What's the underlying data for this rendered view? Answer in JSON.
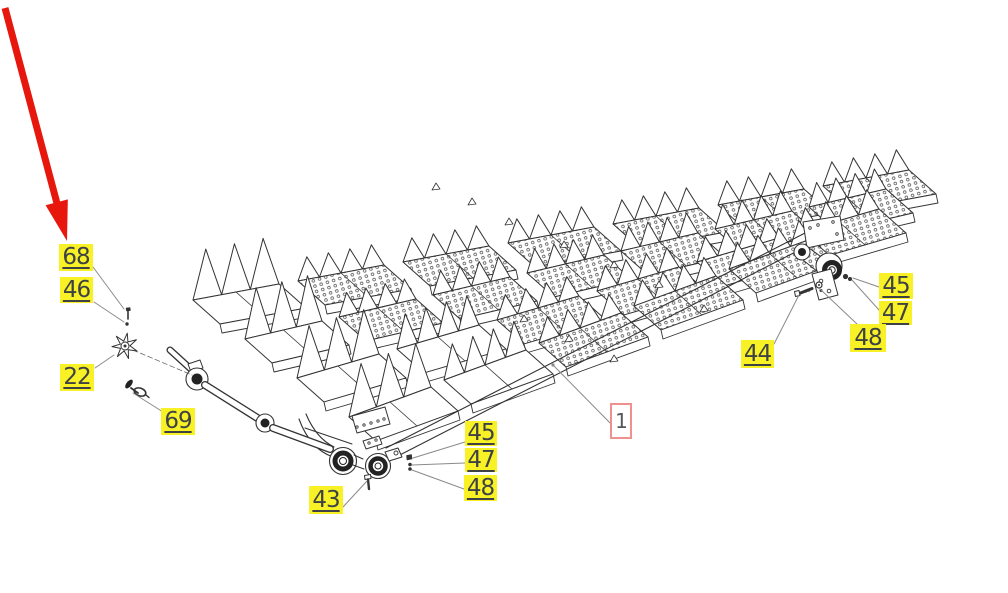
{
  "figure": {
    "kind": "exploded-parts-diagram",
    "subject": "combine straw walker assembly",
    "background_color": "#ffffff",
    "line_color": "#333333",
    "leader_color": "#8a8a8a",
    "highlight_color": "#f7f125",
    "label_text_color": "#3f4245",
    "ref_border_color": "#ef918f",
    "arrow_color": "#e8170d"
  },
  "callouts": [
    {
      "id": "68",
      "text": "68",
      "style": "highlight",
      "box": {
        "x": 59,
        "y": 244,
        "w": 34,
        "h": 27
      },
      "leader": [
        [
          93,
          267
        ],
        [
          124,
          309
        ]
      ]
    },
    {
      "id": "46",
      "text": "46",
      "style": "highlight",
      "box": {
        "x": 60,
        "y": 277,
        "w": 33,
        "h": 26
      },
      "leader": [
        [
          94,
          302
        ],
        [
          124,
          322
        ]
      ]
    },
    {
      "id": "22",
      "text": "22",
      "style": "highlight",
      "box": {
        "x": 60,
        "y": 364,
        "w": 34,
        "h": 27
      },
      "leader": [
        [
          95,
          368
        ],
        [
          114,
          355
        ]
      ]
    },
    {
      "id": "69",
      "text": "69",
      "style": "highlight",
      "box": {
        "x": 161,
        "y": 408,
        "w": 34,
        "h": 27
      },
      "leader": [
        [
          163,
          412
        ],
        [
          133,
          393
        ]
      ]
    },
    {
      "id": "43",
      "text": "43",
      "style": "highlight",
      "box": {
        "x": 309,
        "y": 486,
        "w": 34,
        "h": 28
      },
      "leader": [
        [
          343,
          507
        ],
        [
          367,
          481
        ]
      ]
    },
    {
      "id": "45-left",
      "text": "45",
      "style": "highlight",
      "box": {
        "x": 465,
        "y": 421,
        "w": 32,
        "h": 25
      },
      "leader": [
        [
          465,
          442
        ],
        [
          413,
          458
        ]
      ]
    },
    {
      "id": "47-left",
      "text": "47",
      "style": "highlight",
      "box": {
        "x": 465,
        "y": 448,
        "w": 32,
        "h": 24
      },
      "leader": [
        [
          465,
          463
        ],
        [
          412,
          465
        ]
      ]
    },
    {
      "id": "48-left",
      "text": "48",
      "style": "highlight",
      "box": {
        "x": 464,
        "y": 475,
        "w": 33,
        "h": 26
      },
      "leader": [
        [
          464,
          489
        ],
        [
          412,
          470
        ]
      ]
    },
    {
      "id": "44",
      "text": "44",
      "style": "highlight",
      "box": {
        "x": 741,
        "y": 340,
        "w": 33,
        "h": 28
      },
      "leader": [
        [
          774,
          344
        ],
        [
          799,
          295
        ]
      ]
    },
    {
      "id": "45-right",
      "text": "45",
      "style": "highlight",
      "box": {
        "x": 879,
        "y": 273,
        "w": 34,
        "h": 26
      },
      "leader": [
        [
          879,
          287
        ],
        [
          853,
          278
        ]
      ]
    },
    {
      "id": "47-right",
      "text": "47",
      "style": "highlight",
      "box": {
        "x": 879,
        "y": 301,
        "w": 33,
        "h": 24
      },
      "leader": [
        [
          879,
          310
        ],
        [
          852,
          280
        ]
      ]
    },
    {
      "id": "48-right",
      "text": "48",
      "style": "highlight",
      "box": {
        "x": 850,
        "y": 324,
        "w": 36,
        "h": 28
      },
      "leader": [
        [
          857,
          324
        ],
        [
          820,
          289
        ]
      ]
    },
    {
      "id": "1",
      "text": "1",
      "style": "ref",
      "box": {
        "x": 610,
        "y": 403,
        "w": 22,
        "h": 36
      },
      "leader": [
        [
          615,
          428
        ],
        [
          553,
          365
        ]
      ],
      "leader_dot": true
    }
  ],
  "arrow": {
    "points_to_callout": "68",
    "tail": [
      5,
      8
    ],
    "tip": [
      67,
      241
    ]
  }
}
